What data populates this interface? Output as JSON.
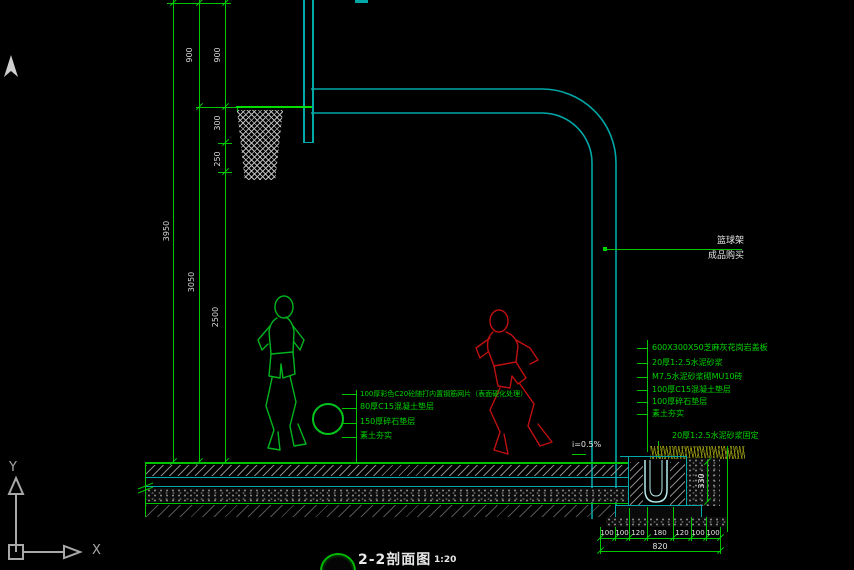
{
  "title": {
    "name": "2-2剖面图",
    "scale": "1:20"
  },
  "axis": {
    "x": "X",
    "y": "Y"
  },
  "dims": {
    "total": "3950",
    "rim": "3050",
    "clear": "2500",
    "top_a": "900",
    "top_b": "900",
    "seg300": "300",
    "seg250": "250",
    "drain": "330",
    "slope": "i=0.5%",
    "bottom_segments": [
      "100",
      "100",
      "120",
      "180",
      "120",
      "100",
      "100"
    ],
    "bottom_total": "820"
  },
  "pole_label": {
    "line1": "篮球架",
    "line2": "成品购买"
  },
  "court_notes": [
    "100厚彩色C20砼随打内置钢筋网片（表面硬化处理）",
    "80厚C15混凝土垫层",
    "150厚碎石垫层",
    "素土夯实"
  ],
  "edge_notes": [
    "600X300X50芝麻灰花岗岩盖板",
    "20厚1:2.5水泥砂浆",
    "M7.5水泥砂浆砌MU10砖",
    "100厚C15混凝土垫层",
    "100厚碎石垫层",
    "素土夯实"
  ],
  "mortar_label": "20厚1:2.5水泥砂浆固定",
  "colors": {
    "line_green": "#00c400",
    "cad_cyan": "#00a8a8",
    "note_green": "#00d400",
    "dim_text": "#d6d6d6",
    "player_red": "#c01010",
    "player_green": "#00b41e",
    "grass": "#7d7d00"
  }
}
